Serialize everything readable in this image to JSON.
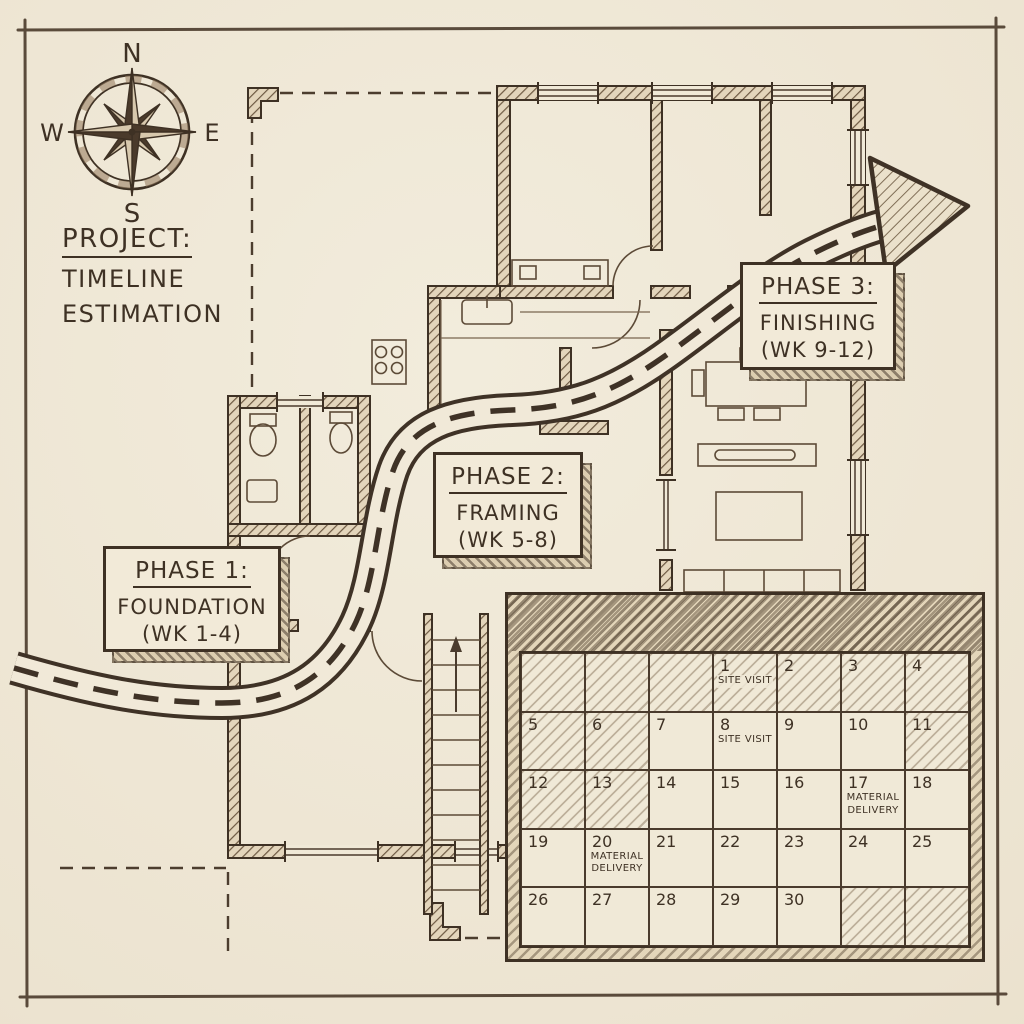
{
  "colors": {
    "paper": "#efe8d8",
    "ink": "#3e3124",
    "wall_hatch": "#6d5942"
  },
  "title": {
    "line1": "PROJECT:",
    "line2": "TIMELINE",
    "line3": "ESTIMATION"
  },
  "compass": {
    "north": "N",
    "east": "E",
    "south": "S",
    "west": "W"
  },
  "phases": [
    {
      "heading": "PHASE 1:",
      "name": "FOUNDATION",
      "weeks": "(WK 1-4)"
    },
    {
      "heading": "PHASE 2:",
      "name": "FRAMING",
      "weeks": "(WK 5-8)"
    },
    {
      "heading": "PHASE 3:",
      "name": "FINISHING",
      "weeks": "(WK 9-12)"
    }
  ],
  "timeline_road": {
    "style": "winding road with dashed center line",
    "arrow_icon": "arrow-right-icon"
  },
  "calendar": {
    "rows": 5,
    "cols": 7,
    "cells": [
      {
        "day": "",
        "hatched": true
      },
      {
        "day": "",
        "hatched": true
      },
      {
        "day": "",
        "hatched": true
      },
      {
        "day": "1",
        "event": "SITE VISIT",
        "hatched": true
      },
      {
        "day": "2",
        "hatched": true
      },
      {
        "day": "3",
        "hatched": true
      },
      {
        "day": "4",
        "hatched": true
      },
      {
        "day": "5",
        "hatched": true
      },
      {
        "day": "6",
        "hatched": true
      },
      {
        "day": "7"
      },
      {
        "day": "8",
        "event": "SITE VISIT"
      },
      {
        "day": "9"
      },
      {
        "day": "10"
      },
      {
        "day": "11",
        "hatched": true
      },
      {
        "day": "12",
        "hatched": true
      },
      {
        "day": "13",
        "hatched": true
      },
      {
        "day": "14"
      },
      {
        "day": "15"
      },
      {
        "day": "16"
      },
      {
        "day": "17",
        "event": "MATERIAL DELIVERY"
      },
      {
        "day": "18"
      },
      {
        "day": "19"
      },
      {
        "day": "20",
        "event": "MATERIAL DELIVERY"
      },
      {
        "day": "21"
      },
      {
        "day": "22"
      },
      {
        "day": "23"
      },
      {
        "day": "24"
      },
      {
        "day": "25"
      },
      {
        "day": "26"
      },
      {
        "day": "27"
      },
      {
        "day": "28"
      },
      {
        "day": "29"
      },
      {
        "day": "30"
      },
      {
        "day": "",
        "hatched": true
      },
      {
        "day": "",
        "hatched": true
      }
    ]
  }
}
